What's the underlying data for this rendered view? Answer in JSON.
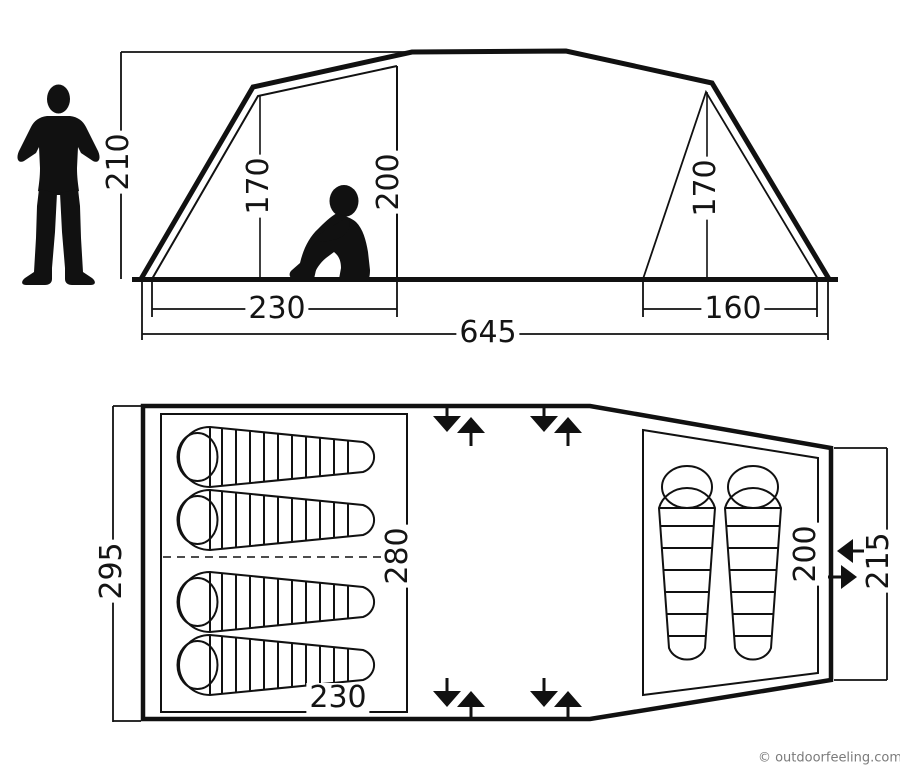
{
  "diagram_title": "tent-dimension-diagram",
  "side_view": {
    "labels": {
      "peak_height": "210",
      "left_room_height": "170",
      "center_inner_height": "200",
      "right_room_height": "170",
      "left_room_width": "230",
      "right_room_width": "160",
      "total_length": "645"
    }
  },
  "floor_plan": {
    "labels": {
      "total_width": "295",
      "inner_width": "280",
      "left_room_length": "230",
      "right_room_length": "200",
      "right_section_width": "215"
    }
  },
  "watermark": "© outdoorfeeling.com",
  "colors": {
    "line": "#111111",
    "watermark_text": "#7a7a7a",
    "background": "#ffffff"
  },
  "icons": {
    "standing_person": "human figure for scale",
    "sitting_person": "seated human figure for scale",
    "sleeping_bag_horizontal": "mummy sleeping bag, head left",
    "sleeping_bag_vertical": "mummy sleeping bag, head top",
    "vent_arrows": "paired in/out ventilation arrows"
  }
}
